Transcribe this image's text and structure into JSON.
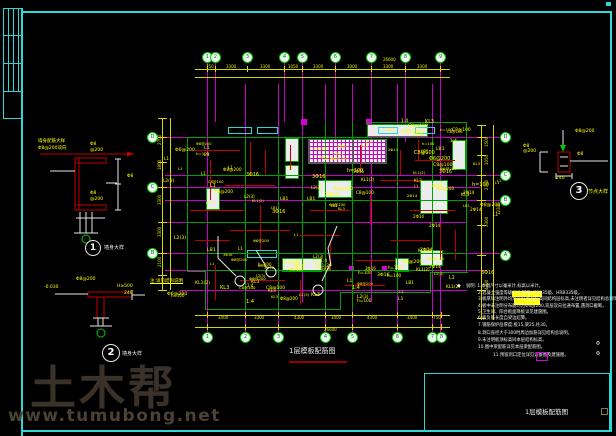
{
  "watermark": {
    "brand": "土木帮",
    "url": "www.tumubong.net"
  },
  "plan": {
    "title": "1层模板配筋图",
    "underline": [
      289,
      361,
      58,
      2
    ]
  },
  "title_block": {
    "label": "1层模板配筋图",
    "box": [
      424,
      373,
      186,
      58
    ]
  },
  "art": {
    "frame": [
      [
        21,
        11,
        591,
        2
      ],
      [
        610,
        11,
        2,
        421
      ],
      [
        21,
        430,
        591,
        2
      ],
      [
        21,
        8,
        2,
        428
      ],
      [
        3,
        8,
        19,
        1
      ],
      [
        3,
        35,
        19,
        1
      ],
      [
        3,
        63,
        19,
        1
      ],
      [
        3,
        91,
        19,
        1
      ],
      [
        3,
        8,
        1,
        84
      ],
      [
        8,
        8,
        1,
        84
      ],
      [
        13,
        8,
        1,
        84
      ],
      [
        18,
        8,
        1,
        84
      ],
      [
        3,
        91,
        1,
        28
      ],
      [
        3,
        118,
        19,
        1
      ],
      [
        606,
        2,
        5,
        4
      ]
    ],
    "grid": [
      [
        207,
        62,
        1,
        270
      ],
      [
        215,
        62,
        1,
        60
      ],
      [
        245,
        84,
        1,
        248
      ],
      [
        278,
        84,
        1,
        248
      ],
      [
        284,
        62,
        1,
        60
      ],
      [
        302,
        62,
        1,
        240
      ],
      [
        325,
        84,
        1,
        248
      ],
      [
        335,
        62,
        1,
        80
      ],
      [
        352,
        84,
        1,
        248
      ],
      [
        371,
        62,
        1,
        240
      ],
      [
        397,
        84,
        1,
        248
      ],
      [
        405,
        62,
        1,
        80
      ],
      [
        432,
        84,
        1,
        248
      ],
      [
        440,
        62,
        1,
        270
      ],
      [
        158,
        137,
        342,
        1
      ],
      [
        165,
        175,
        335,
        1
      ],
      [
        158,
        187,
        322,
        1
      ],
      [
        165,
        200,
        335,
        1
      ],
      [
        165,
        222,
        302,
        1
      ],
      [
        158,
        253,
        342,
        1
      ],
      [
        165,
        270,
        322,
        1
      ],
      [
        180,
        290,
        287,
        1
      ]
    ],
    "dims": [
      [
        195,
        69,
        255,
        1
      ],
      [
        195,
        77,
        255,
        1
      ],
      [
        195,
        315,
        255,
        1
      ],
      [
        195,
        327,
        255,
        1
      ],
      [
        162,
        118,
        1,
        172
      ],
      [
        170,
        118,
        1,
        172
      ],
      [
        481,
        125,
        1,
        195
      ],
      [
        493,
        125,
        1,
        195
      ],
      [
        207,
        66,
        1,
        6
      ],
      [
        215,
        66,
        1,
        6
      ],
      [
        247,
        66,
        1,
        6
      ],
      [
        284,
        66,
        1,
        6
      ],
      [
        302,
        66,
        1,
        6
      ],
      [
        335,
        66,
        1,
        6
      ],
      [
        371,
        66,
        1,
        6
      ],
      [
        405,
        66,
        1,
        6
      ],
      [
        440,
        66,
        1,
        6
      ],
      [
        207,
        312,
        1,
        6
      ],
      [
        245,
        312,
        1,
        6
      ],
      [
        278,
        312,
        1,
        6
      ],
      [
        325,
        312,
        1,
        6
      ],
      [
        352,
        312,
        1,
        6
      ],
      [
        397,
        312,
        1,
        6
      ],
      [
        432,
        312,
        1,
        6
      ],
      [
        441,
        312,
        1,
        6
      ],
      [
        207,
        324,
        1,
        6
      ],
      [
        245,
        324,
        1,
        6
      ],
      [
        278,
        324,
        1,
        6
      ],
      [
        325,
        324,
        1,
        6
      ],
      [
        352,
        324,
        1,
        6
      ],
      [
        397,
        324,
        1,
        6
      ],
      [
        432,
        324,
        1,
        6
      ],
      [
        441,
        324,
        1,
        6
      ],
      [
        158,
        118,
        9,
        1
      ],
      [
        158,
        137,
        9,
        1
      ],
      [
        158,
        162,
        9,
        1
      ],
      [
        158,
        187,
        9,
        1
      ],
      [
        158,
        222,
        9,
        1
      ],
      [
        158,
        253,
        9,
        1
      ],
      [
        158,
        275,
        9,
        1
      ],
      [
        158,
        290,
        9,
        1
      ],
      [
        477,
        125,
        9,
        1
      ],
      [
        477,
        137,
        9,
        1
      ],
      [
        477,
        155,
        9,
        1
      ],
      [
        477,
        175,
        9,
        1
      ],
      [
        477,
        200,
        9,
        1
      ],
      [
        477,
        225,
        9,
        1
      ],
      [
        477,
        255,
        9,
        1
      ],
      [
        477,
        290,
        9,
        1
      ],
      [
        477,
        318,
        9,
        1
      ]
    ],
    "walls": [
      [
        187,
        137,
        1,
        135
      ],
      [
        187,
        271,
        19,
        1
      ],
      [
        205,
        271,
        1,
        39
      ],
      [
        205,
        309,
        136,
        1
      ],
      [
        340,
        292,
        1,
        18
      ],
      [
        340,
        292,
        91,
        1
      ],
      [
        430,
        272,
        1,
        21
      ],
      [
        430,
        272,
        38,
        1
      ],
      [
        466,
        122,
        1,
        151
      ],
      [
        367,
        122,
        100,
        1
      ],
      [
        367,
        122,
        1,
        16
      ],
      [
        187,
        137,
        181,
        1
      ],
      [
        245,
        137,
        1,
        173
      ],
      [
        278,
        137,
        1,
        173
      ],
      [
        302,
        137,
        1,
        135
      ],
      [
        325,
        122,
        1,
        188
      ],
      [
        352,
        122,
        1,
        188
      ],
      [
        397,
        137,
        1,
        156
      ],
      [
        432,
        137,
        1,
        136
      ],
      [
        187,
        175,
        116,
        1
      ],
      [
        187,
        222,
        166,
        1
      ],
      [
        302,
        200,
        165,
        1
      ],
      [
        187,
        253,
        280,
        1
      ],
      [
        205,
        270,
        226,
        1
      ]
    ],
    "beams": [
      [
        195,
        150,
        45,
        1
      ],
      [
        210,
        160,
        1,
        40
      ],
      [
        225,
        185,
        50,
        1
      ],
      [
        250,
        142,
        1,
        33
      ],
      [
        190,
        210,
        55,
        1
      ],
      [
        230,
        230,
        60,
        1
      ],
      [
        260,
        205,
        1,
        45
      ],
      [
        290,
        145,
        1,
        25
      ],
      [
        310,
        210,
        40,
        1
      ],
      [
        330,
        240,
        1,
        30
      ],
      [
        300,
        235,
        40,
        1
      ],
      [
        360,
        145,
        1,
        25
      ],
      [
        380,
        180,
        40,
        1
      ],
      [
        400,
        150,
        1,
        25
      ],
      [
        410,
        210,
        45,
        1
      ],
      [
        440,
        225,
        1,
        35
      ],
      [
        390,
        240,
        40,
        1
      ],
      [
        215,
        265,
        1,
        35
      ],
      [
        240,
        280,
        45,
        1
      ],
      [
        300,
        280,
        1,
        25
      ],
      [
        355,
        260,
        40,
        1
      ],
      [
        415,
        160,
        40,
        1
      ],
      [
        370,
        195,
        1,
        30
      ],
      [
        195,
        240,
        35,
        1
      ],
      [
        265,
        150,
        1,
        25
      ],
      [
        345,
        285,
        40,
        1
      ],
      [
        418,
        140,
        1,
        20
      ],
      [
        455,
        230,
        1,
        30
      ]
    ],
    "rooms": [
      [
        285,
        138,
        14,
        24
      ],
      [
        285,
        165,
        14,
        14
      ],
      [
        318,
        180,
        34,
        18
      ],
      [
        206,
        188,
        14,
        22
      ],
      [
        282,
        258,
        40,
        14
      ],
      [
        395,
        258,
        14,
        14
      ],
      [
        420,
        180,
        28,
        34
      ],
      [
        420,
        250,
        23,
        16
      ],
      [
        367,
        124,
        61,
        13
      ],
      [
        452,
        140,
        14,
        30
      ]
    ],
    "cyan": [
      [
        228,
        127,
        24,
        7
      ],
      [
        257,
        127,
        21,
        7
      ],
      [
        378,
        127,
        20,
        7
      ],
      [
        415,
        127,
        20,
        7
      ],
      [
        247,
        250,
        30,
        8
      ]
    ],
    "msq": [
      [
        301,
        119,
        6,
        6
      ],
      [
        366,
        119,
        6,
        6
      ],
      [
        349,
        266,
        5,
        5
      ],
      [
        382,
        266,
        5,
        5
      ]
    ],
    "hatch": [
      308,
      139,
      77,
      23
    ]
  },
  "bubbles": [
    {
      "x": 207,
      "y": 57,
      "l": "1"
    },
    {
      "x": 215,
      "y": 57,
      "l": "2"
    },
    {
      "x": 247,
      "y": 57,
      "l": "3"
    },
    {
      "x": 284,
      "y": 57,
      "l": "4"
    },
    {
      "x": 302,
      "y": 57,
      "l": "5"
    },
    {
      "x": 335,
      "y": 57,
      "l": "6"
    },
    {
      "x": 371,
      "y": 57,
      "l": "7"
    },
    {
      "x": 405,
      "y": 57,
      "l": "8"
    },
    {
      "x": 440,
      "y": 57,
      "l": "9"
    },
    {
      "x": 207,
      "y": 337,
      "l": "1"
    },
    {
      "x": 245,
      "y": 337,
      "l": "2"
    },
    {
      "x": 278,
      "y": 337,
      "l": "3"
    },
    {
      "x": 325,
      "y": 337,
      "l": "4"
    },
    {
      "x": 352,
      "y": 337,
      "l": "5"
    },
    {
      "x": 397,
      "y": 337,
      "l": "6"
    },
    {
      "x": 432,
      "y": 337,
      "l": "7"
    },
    {
      "x": 441,
      "y": 337,
      "l": "8"
    },
    {
      "x": 152,
      "y": 137,
      "l": "D"
    },
    {
      "x": 152,
      "y": 187,
      "l": "C"
    },
    {
      "x": 152,
      "y": 253,
      "l": "B"
    },
    {
      "x": 505,
      "y": 137,
      "l": "D"
    },
    {
      "x": 505,
      "y": 175,
      "l": "C"
    },
    {
      "x": 505,
      "y": 200,
      "l": "B"
    },
    {
      "x": 505,
      "y": 255,
      "l": "A"
    }
  ],
  "texts": [
    {
      "x": 206,
      "y": 65,
      "t": "750",
      "c": "t-dim"
    },
    {
      "x": 226,
      "y": 65,
      "t": "3300",
      "c": "t-dim"
    },
    {
      "x": 260,
      "y": 65,
      "t": "3300",
      "c": "t-dim"
    },
    {
      "x": 288,
      "y": 65,
      "t": "1050",
      "c": "t-dim"
    },
    {
      "x": 313,
      "y": 65,
      "t": "3300",
      "c": "t-dim"
    },
    {
      "x": 347,
      "y": 65,
      "t": "3000",
      "c": "t-dim"
    },
    {
      "x": 383,
      "y": 65,
      "t": "3300",
      "c": "t-dim"
    },
    {
      "x": 417,
      "y": 65,
      "t": "3300",
      "c": "t-dim"
    },
    {
      "x": 383,
      "y": 58,
      "t": "26600",
      "c": "t-dim"
    },
    {
      "x": 218,
      "y": 316,
      "t": "3400",
      "c": "t-dim"
    },
    {
      "x": 254,
      "y": 316,
      "t": "3300",
      "c": "t-dim"
    },
    {
      "x": 294,
      "y": 316,
      "t": "4300",
      "c": "t-dim"
    },
    {
      "x": 331,
      "y": 316,
      "t": "3400",
      "c": "t-dim"
    },
    {
      "x": 367,
      "y": 316,
      "t": "4300",
      "c": "t-dim"
    },
    {
      "x": 407,
      "y": 316,
      "t": "3400",
      "c": "t-dim"
    },
    {
      "x": 433,
      "y": 316,
      "t": "750",
      "c": "t-dim"
    },
    {
      "x": 324,
      "y": 328,
      "t": "26600",
      "c": "t-dim"
    },
    {
      "x": 158,
      "y": 145,
      "t": "2700",
      "c": "t-dim",
      "r": 1
    },
    {
      "x": 158,
      "y": 170,
      "t": "1800",
      "c": "t-dim",
      "r": 1
    },
    {
      "x": 158,
      "y": 205,
      "t": "3300",
      "c": "t-dim",
      "r": 1
    },
    {
      "x": 158,
      "y": 237,
      "t": "3300",
      "c": "t-dim",
      "r": 1
    },
    {
      "x": 158,
      "y": 267,
      "t": "2100",
      "c": "t-dim",
      "r": 1
    },
    {
      "x": 485,
      "y": 147,
      "t": "1500",
      "c": "t-dim",
      "r": 1
    },
    {
      "x": 485,
      "y": 165,
      "t": "1050",
      "c": "t-dim",
      "r": 1
    },
    {
      "x": 485,
      "y": 190,
      "t": "2700",
      "c": "t-dim",
      "r": 1
    },
    {
      "x": 485,
      "y": 227,
      "t": "3300",
      "c": "t-dim",
      "r": 1
    },
    {
      "x": 485,
      "y": 290,
      "t": "4200",
      "c": "t-dim",
      "r": 1
    },
    {
      "x": 497,
      "y": 215,
      "t": "12300",
      "c": "t-dim",
      "r": 1
    },
    {
      "x": 38,
      "y": 140,
      "t": "墙身配筋大样",
      "c": "t-lab"
    },
    {
      "x": 38,
      "y": 147,
      "t": "Φ8@200双向",
      "c": "t-lab"
    },
    {
      "x": 90,
      "y": 143,
      "t": "Φ8",
      "c": "t-lab"
    },
    {
      "x": 90,
      "y": 149,
      "t": "@200",
      "c": "t-lab"
    },
    {
      "x": 90,
      "y": 192,
      "t": "Φ8",
      "c": "t-lab"
    },
    {
      "x": 90,
      "y": 198,
      "t": "@200",
      "c": "t-lab"
    },
    {
      "x": 127,
      "y": 175,
      "t": "Φ8",
      "c": "t-lab"
    },
    {
      "x": 44,
      "y": 286,
      "t": "-0.030",
      "c": "t-lab"
    },
    {
      "x": 76,
      "y": 278,
      "t": "Φ8@200",
      "c": "t-lab"
    },
    {
      "x": 117,
      "y": 285,
      "t": "H≥500",
      "c": "t-lab"
    },
    {
      "x": 124,
      "y": 292,
      "t": "240",
      "c": "t-lab"
    },
    {
      "x": 150,
      "y": 280,
      "t": "注:详见结构说明",
      "c": "t-lab",
      "u": 1
    },
    {
      "x": 575,
      "y": 130,
      "t": "Φ8@200",
      "c": "t-lab"
    },
    {
      "x": 577,
      "y": 153,
      "t": "Φ8",
      "c": "t-lab"
    },
    {
      "x": 523,
      "y": 145,
      "t": "Φ8",
      "c": "t-lab"
    },
    {
      "x": 523,
      "y": 150,
      "t": "@200",
      "c": "t-lab"
    },
    {
      "x": 556,
      "y": 177,
      "t": "240",
      "c": "t-lab"
    },
    {
      "x": 104,
      "y": 246,
      "t": "墙身大样",
      "c": "t-cap"
    },
    {
      "x": 122,
      "y": 352,
      "t": "墙身大样",
      "c": "t-cap"
    },
    {
      "x": 588,
      "y": 190,
      "t": "节点大样",
      "c": "t-capy"
    }
  ],
  "notes": {
    "lead": "◆",
    "lead_x": 457,
    "lead_y": 284,
    "lines": [
      {
        "x": 466,
        "y": 285,
        "t": "说明: 1.本图尺寸以毫米计,标高以米计。"
      },
      {
        "x": 478,
        "y": 292,
        "t": "2.混凝土强度等级C25,钢筋HPB235级、HRB335级。"
      },
      {
        "x": 478,
        "y": 298,
        "t": "3.板厚除注明外均为100,板面标高同结构层标高,未注明者详见结构总说明。"
      },
      {
        "x": 478,
        "y": 305,
        "t": "4.板中未注明分布筋均为Φ6@200,双层双向拉通布置,遇洞口截断。"
      },
      {
        "x": 478,
        "y": 311,
        "t": "5.卫生间、阳台板面降板详见建施图。"
      },
      {
        "x": 478,
        "y": 317,
        "t": "6.板负筋长度自梁边起算。"
      },
      {
        "x": 478,
        "y": 324,
        "t": "7.钢筋保护层厚度:板15,梁25,柱30。"
      },
      {
        "x": 478,
        "y": 332,
        "t": "8.洞口直径大于300时周边加筋详见结构总说明。"
      },
      {
        "x": 478,
        "y": 339,
        "t": "9.未注明板顶标高同本层结构标高。"
      },
      {
        "x": 478,
        "y": 346,
        "t": "10.图中梁配筋详见本层梁配筋图。"
      },
      {
        "x": 493,
        "y": 354,
        "t": "11.预留洞口定位详见设备图及建施图。"
      }
    ],
    "highlights": [
      [
        512,
        291,
        30,
        6
      ],
      [
        514,
        298,
        26,
        7
      ]
    ],
    "magenta_box": [
      536,
      352,
      12,
      9
    ],
    "phi_marks": [
      {
        "x": 596,
        "y": 342,
        "t": "Φ"
      },
      {
        "x": 596,
        "y": 352,
        "t": "Φ"
      }
    ]
  },
  "details": [
    {
      "n": "1",
      "x": 92,
      "y": 247,
      "r": 7
    },
    {
      "n": "2",
      "x": 110,
      "y": 352,
      "r": 8
    },
    {
      "n": "3",
      "x": 578,
      "y": 190,
      "r": 8
    }
  ],
  "scatter": {
    "seed": 13,
    "glyphs": [
      "KL1(2)",
      "L1",
      "L2(3)",
      "LB1",
      "Φ8@200",
      "2Φ14",
      "3Φ16",
      "Φ6@200",
      "C8@100",
      "KL3",
      "h=100",
      "1:4"
    ],
    "regions": [
      [
        192,
        142,
        106,
        160,
        40
      ],
      [
        305,
        166,
        58,
        138,
        22
      ],
      [
        386,
        140,
        78,
        148,
        30
      ],
      [
        370,
        119,
        90,
        16,
        10
      ],
      [
        310,
        141,
        72,
        18,
        8
      ],
      [
        152,
        148,
        30,
        150,
        7
      ],
      [
        470,
        150,
        28,
        155,
        8
      ],
      [
        210,
        258,
        215,
        48,
        14
      ]
    ]
  },
  "colors": {
    "frame": "#2fd6d6",
    "grid": "#c800c8",
    "dim": "#d8d800",
    "wall": "#00a000",
    "beam": "#c00000",
    "bubble": "#00cc00",
    "slab": "#ececec",
    "label": "#ffff00",
    "watermark": "#3a3129"
  }
}
